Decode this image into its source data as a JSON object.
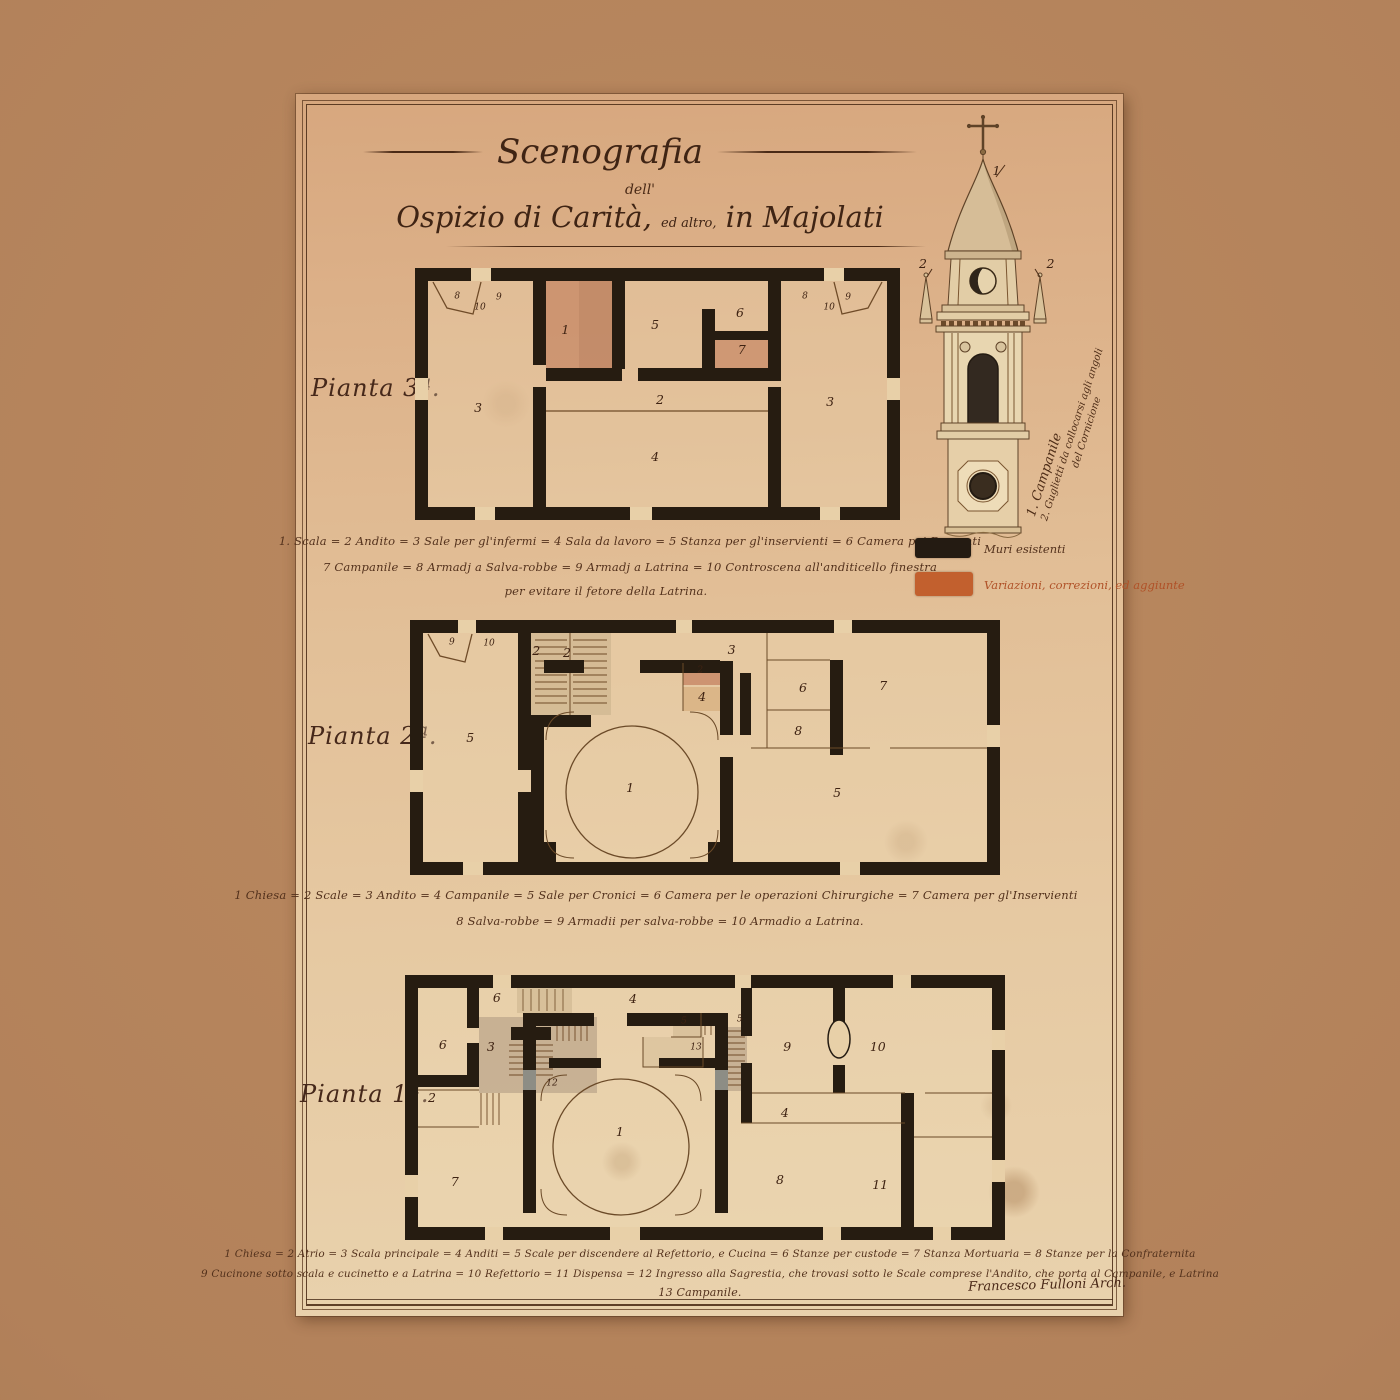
{
  "title": {
    "main": "Scenografia",
    "sub": "dell'",
    "line2_a": "Ospizio di Carità,",
    "line2_b": "ed altro,",
    "line2_c": "in Majolati"
  },
  "campanile": {
    "caption1": "1. Campanile",
    "caption2": "2. Guglietti da collocarsi agli angoli",
    "caption3": "del Cornicione",
    "nums": [
      {
        "t": "1",
        "x": 59,
        "y": 14.5
      },
      {
        "t": "2",
        "x": 10,
        "y": 36
      },
      {
        "t": "2",
        "x": 95,
        "y": 36
      }
    ]
  },
  "legend": {
    "existing_label": "Muri esistenti",
    "existing_color": "#241b12",
    "changes_label": "Variazioni, correzioni, ed aggiunte",
    "changes_color": "#c2602e"
  },
  "plans": [
    {
      "name": "Pianta 3ª.",
      "caption": [
        "1. Scala = 2 Andito = 3 Sale per gl'infermi = 4 Sala da lavoro = 5 Stanza per gl'inservienti = 6 Camera pei Dementi",
        "7 Campanile = 8 Armadj a Salva-robbe = 9 Armadj a Latrina = 10 Controscena all'anditicello finestra",
        "per evitare il fetore della Latrina."
      ],
      "rooms": [
        {
          "t": "8",
          "x": 8.7,
          "y": 11.5,
          "s": "s"
        },
        {
          "t": "10",
          "x": 13.4,
          "y": 15.9,
          "s": "s"
        },
        {
          "t": "9",
          "x": 17.3,
          "y": 11.9,
          "s": "s"
        },
        {
          "t": "3",
          "x": 13,
          "y": 55.5
        },
        {
          "t": "1",
          "x": 31,
          "y": 24.6
        },
        {
          "t": "5",
          "x": 49.5,
          "y": 22.6
        },
        {
          "t": "6",
          "x": 67,
          "y": 17.9
        },
        {
          "t": "7",
          "x": 67.4,
          "y": 32.5
        },
        {
          "t": "2",
          "x": 50.5,
          "y": 52.4
        },
        {
          "t": "4",
          "x": 49.5,
          "y": 75
        },
        {
          "t": "3",
          "x": 85.6,
          "y": 53.2
        },
        {
          "t": "8",
          "x": 80.4,
          "y": 11.5,
          "s": "s"
        },
        {
          "t": "10",
          "x": 85.4,
          "y": 15.9,
          "s": "s"
        },
        {
          "t": "9",
          "x": 89.3,
          "y": 11.9,
          "s": "s"
        }
      ]
    },
    {
      "name": "Pianta 2ª.",
      "caption": [
        "1 Chiesa = 2 Scale = 3 Andito = 4 Campanile = 5 Sale per Cronici = 6 Camera per le operazioni Chirurgiche = 7 Camera per gl'Inservienti",
        "8 Salva-robbe = 9 Armadii per salva-robbe = 10 Armadio a Latrina."
      ],
      "rooms": [
        {
          "t": "9",
          "x": 7.1,
          "y": 9,
          "s": "s"
        },
        {
          "t": "10",
          "x": 13.4,
          "y": 9.4,
          "s": "s"
        },
        {
          "t": "5",
          "x": 10.2,
          "y": 46.3
        },
        {
          "t": "2",
          "x": 21.4,
          "y": 12.2
        },
        {
          "t": "2",
          "x": 26.6,
          "y": 12.9
        },
        {
          "t": "3",
          "x": 54.5,
          "y": 11.8
        },
        {
          "t": "2",
          "x": 49.2,
          "y": 20,
          "s": "s"
        },
        {
          "t": "4",
          "x": 49.5,
          "y": 30
        },
        {
          "t": "1",
          "x": 37.3,
          "y": 65.9
        },
        {
          "t": "6",
          "x": 66.6,
          "y": 26.7
        },
        {
          "t": "7",
          "x": 80.2,
          "y": 25.9
        },
        {
          "t": "8",
          "x": 65.8,
          "y": 43.5
        },
        {
          "t": "5",
          "x": 72.4,
          "y": 67.8
        }
      ]
    },
    {
      "name": "Pianta 1ª.",
      "caption": [
        "1 Chiesa = 2 Atrio = 3 Scala principale = 4 Anditi = 5 Scale per discendere al Refettorio, e Cucina = 6 Stanze per custode = 7 Stanza Mortuaria = 8 Stanze per la Confraternita",
        "9 Cucinone sotto scala e cucinetto e a Latrina = 10 Refettorio = 11 Dispensa = 12 Ingresso alla Sagrestia, che trovasi sotto le Scale comprese l'Andito, che porta al Campanile, e Latrina",
        "13 Campanile."
      ],
      "rooms": [
        {
          "t": "6",
          "x": 15.3,
          "y": 8.7
        },
        {
          "t": "6",
          "x": 6.3,
          "y": 26.4
        },
        {
          "t": "3",
          "x": 14.3,
          "y": 27.2
        },
        {
          "t": "4",
          "x": 38,
          "y": 9.1
        },
        {
          "t": "5",
          "x": 46.5,
          "y": 17.7,
          "s": "s"
        },
        {
          "t": "5",
          "x": 55.8,
          "y": 17,
          "s": "s"
        },
        {
          "t": "13",
          "x": 48.5,
          "y": 27.5,
          "s": "s"
        },
        {
          "t": "12",
          "x": 24.5,
          "y": 41,
          "s": "s"
        },
        {
          "t": "2",
          "x": 4.5,
          "y": 46.4
        },
        {
          "t": "1",
          "x": 35.8,
          "y": 59.2
        },
        {
          "t": "7",
          "x": 8.3,
          "y": 78
        },
        {
          "t": "9",
          "x": 63.7,
          "y": 27.2
        },
        {
          "t": "10",
          "x": 78.8,
          "y": 27.2
        },
        {
          "t": "4",
          "x": 63.3,
          "y": 52.1
        },
        {
          "t": "8",
          "x": 62.5,
          "y": 77.4
        },
        {
          "t": "11",
          "x": 79.2,
          "y": 79.2
        }
      ]
    }
  ],
  "signature": "Francesco Fulloni Arch."
}
